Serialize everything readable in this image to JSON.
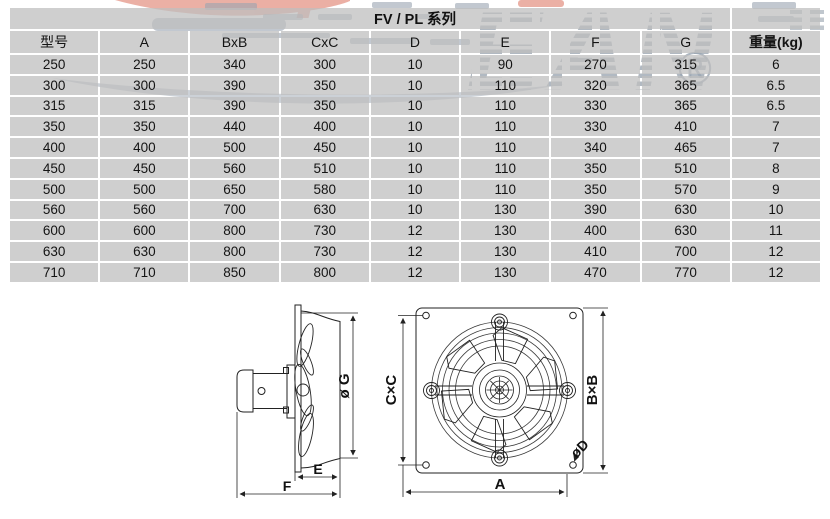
{
  "title": "FV / PL 系列",
  "watermark": {
    "letters": "EAN",
    "registered_mark": "®",
    "stripe_color": "#97a2ae",
    "accent_color": "#e8a295"
  },
  "table": {
    "headers": [
      "型号",
      "A",
      "BxB",
      "CxC",
      "D",
      "E",
      "F",
      "G",
      "重量(kg)"
    ],
    "rows": [
      [
        "250",
        "250",
        "340",
        "300",
        "10",
        "90",
        "270",
        "315",
        "6"
      ],
      [
        "300",
        "300",
        "390",
        "350",
        "10",
        "110",
        "320",
        "365",
        "6.5"
      ],
      [
        "315",
        "315",
        "390",
        "350",
        "10",
        "110",
        "330",
        "365",
        "6.5"
      ],
      [
        "350",
        "350",
        "440",
        "400",
        "10",
        "110",
        "330",
        "410",
        "7"
      ],
      [
        "400",
        "400",
        "500",
        "450",
        "10",
        "110",
        "340",
        "465",
        "7"
      ],
      [
        "450",
        "450",
        "560",
        "510",
        "10",
        "110",
        "350",
        "510",
        "8"
      ],
      [
        "500",
        "500",
        "650",
        "580",
        "10",
        "110",
        "350",
        "570",
        "9"
      ],
      [
        "560",
        "560",
        "700",
        "630",
        "10",
        "130",
        "390",
        "630",
        "10"
      ],
      [
        "600",
        "600",
        "800",
        "730",
        "12",
        "130",
        "400",
        "630",
        "11"
      ],
      [
        "630",
        "630",
        "800",
        "730",
        "12",
        "130",
        "410",
        "700",
        "12"
      ],
      [
        "710",
        "710",
        "850",
        "800",
        "12",
        "130",
        "470",
        "770",
        "12"
      ]
    ]
  },
  "drawings": {
    "side_view": {
      "dim_g": "ø G",
      "dim_e": "E",
      "dim_f": "F"
    },
    "front_view": {
      "dim_a": "A",
      "dim_bxb": "B×B",
      "dim_cxc": "C×C",
      "dim_d": "øD"
    }
  }
}
